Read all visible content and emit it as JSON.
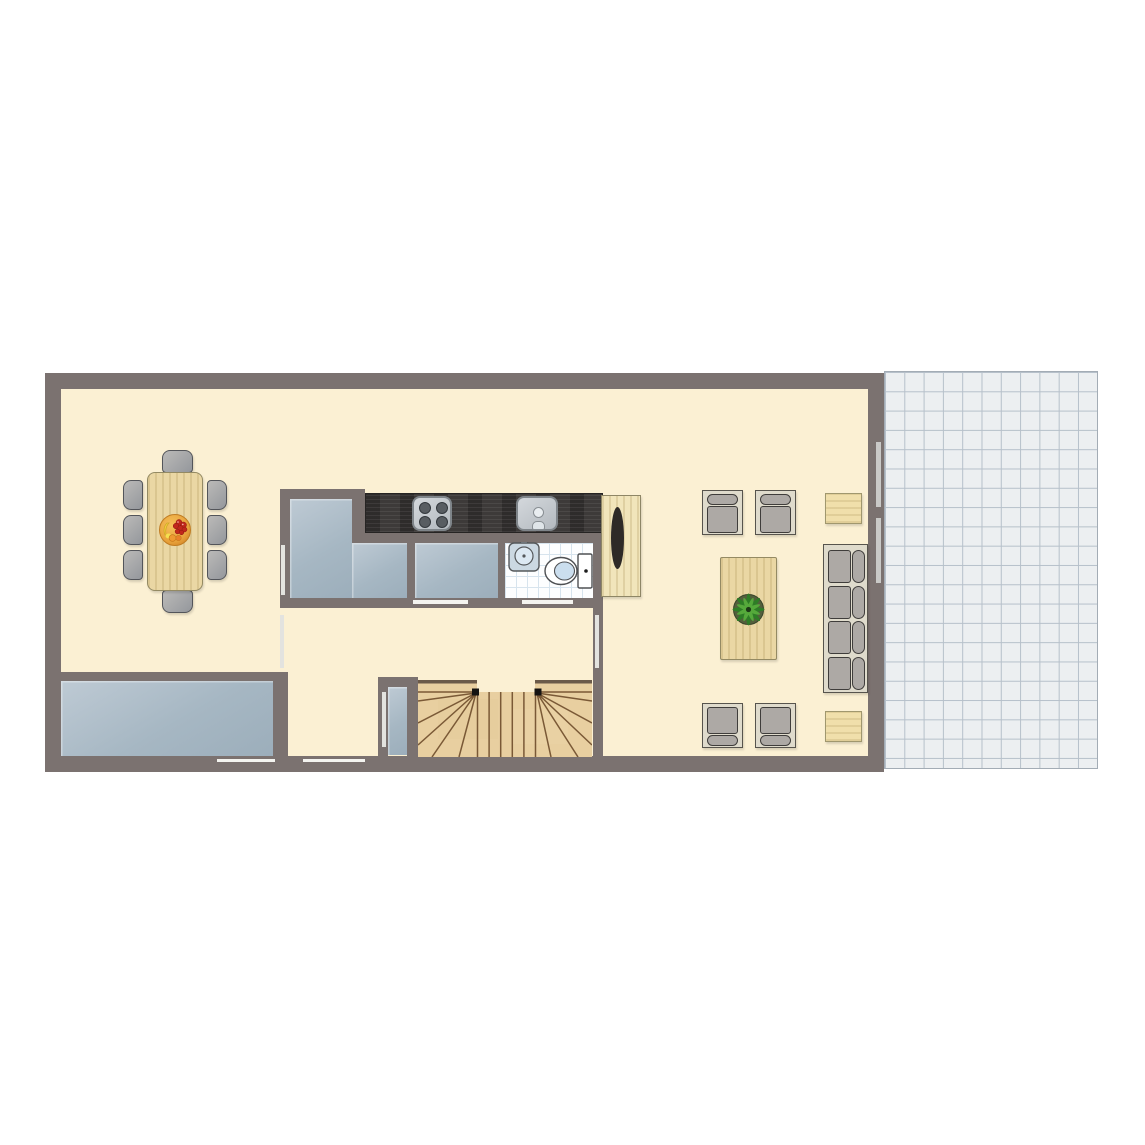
{
  "scene": {
    "kind": "architectural-floor-plan-top-view",
    "background": "#FFFFFF",
    "visible_text": ""
  },
  "palette": {
    "wall": "#7B7270",
    "floor_cream": "#FBF0D3",
    "floor_blue_light": "#BECAD4",
    "floor_blue_dark": "#9CAEBB",
    "patio_tile_bg": "#ECEFF1",
    "patio_tile_line": "#B6C0CA",
    "bath_tile_bg": "#FDFEFF",
    "bath_tile_line": "#D7E4EE",
    "counter_dark": "#3D3A39",
    "wood_light": "#EAD7A4",
    "furniture_gray": "#ADA9A5",
    "furniture_frame": "#DFDBCC",
    "stair_line": "#7A5936",
    "plant_green": "#2E7D26",
    "plant_green_light": "#55A93B",
    "fruit_orange": "#E8A23C",
    "fruit_red": "#C1271B",
    "fruit_yellow": "#F3D039"
  },
  "rooms": [
    {
      "name": "dining-area",
      "floor": "cream"
    },
    {
      "name": "open-kitchen-strip",
      "floor": "cream"
    },
    {
      "name": "storage-room-left",
      "floor": "blue-gray"
    },
    {
      "name": "storage-room-right",
      "floor": "blue-gray"
    },
    {
      "name": "bathroom",
      "floor": "white-tile"
    },
    {
      "name": "hallway",
      "floor": "cream"
    },
    {
      "name": "living-area",
      "floor": "cream"
    },
    {
      "name": "utility-room-bottom-left",
      "floor": "blue-gray"
    },
    {
      "name": "entrance-vestibule",
      "floor": "blue-gray"
    },
    {
      "name": "staircase-well",
      "floor": "wood"
    },
    {
      "name": "patio-terrace",
      "floor": "gray-tile-grid"
    }
  ],
  "furniture": [
    {
      "name": "dining-table",
      "material": "light-wood",
      "chairs": 8
    },
    {
      "name": "fruit-bowl",
      "on": "dining-table"
    },
    {
      "name": "kitchen-counter",
      "material": "dark-wood",
      "appliances": [
        "cooktop-4-burner",
        "kitchen-sink"
      ]
    },
    {
      "name": "bathroom-sink",
      "count": 1
    },
    {
      "name": "toilet",
      "count": 1
    },
    {
      "name": "wardrobe-cabinet",
      "material": "light-wood",
      "count": 1
    },
    {
      "name": "armchair",
      "count": 4
    },
    {
      "name": "sofa",
      "seat_cushions": 4
    },
    {
      "name": "coffee-table",
      "material": "light-wood"
    },
    {
      "name": "potted-plant",
      "on": "coffee-table"
    },
    {
      "name": "side-table",
      "count": 2
    },
    {
      "name": "staircase",
      "shape": "u-shaped-with-winders"
    }
  ],
  "openings": {
    "patio_door_markers_right_wall": 2,
    "interior_door_markers": 6,
    "exterior_door_markers_bottom_wall": 2
  }
}
